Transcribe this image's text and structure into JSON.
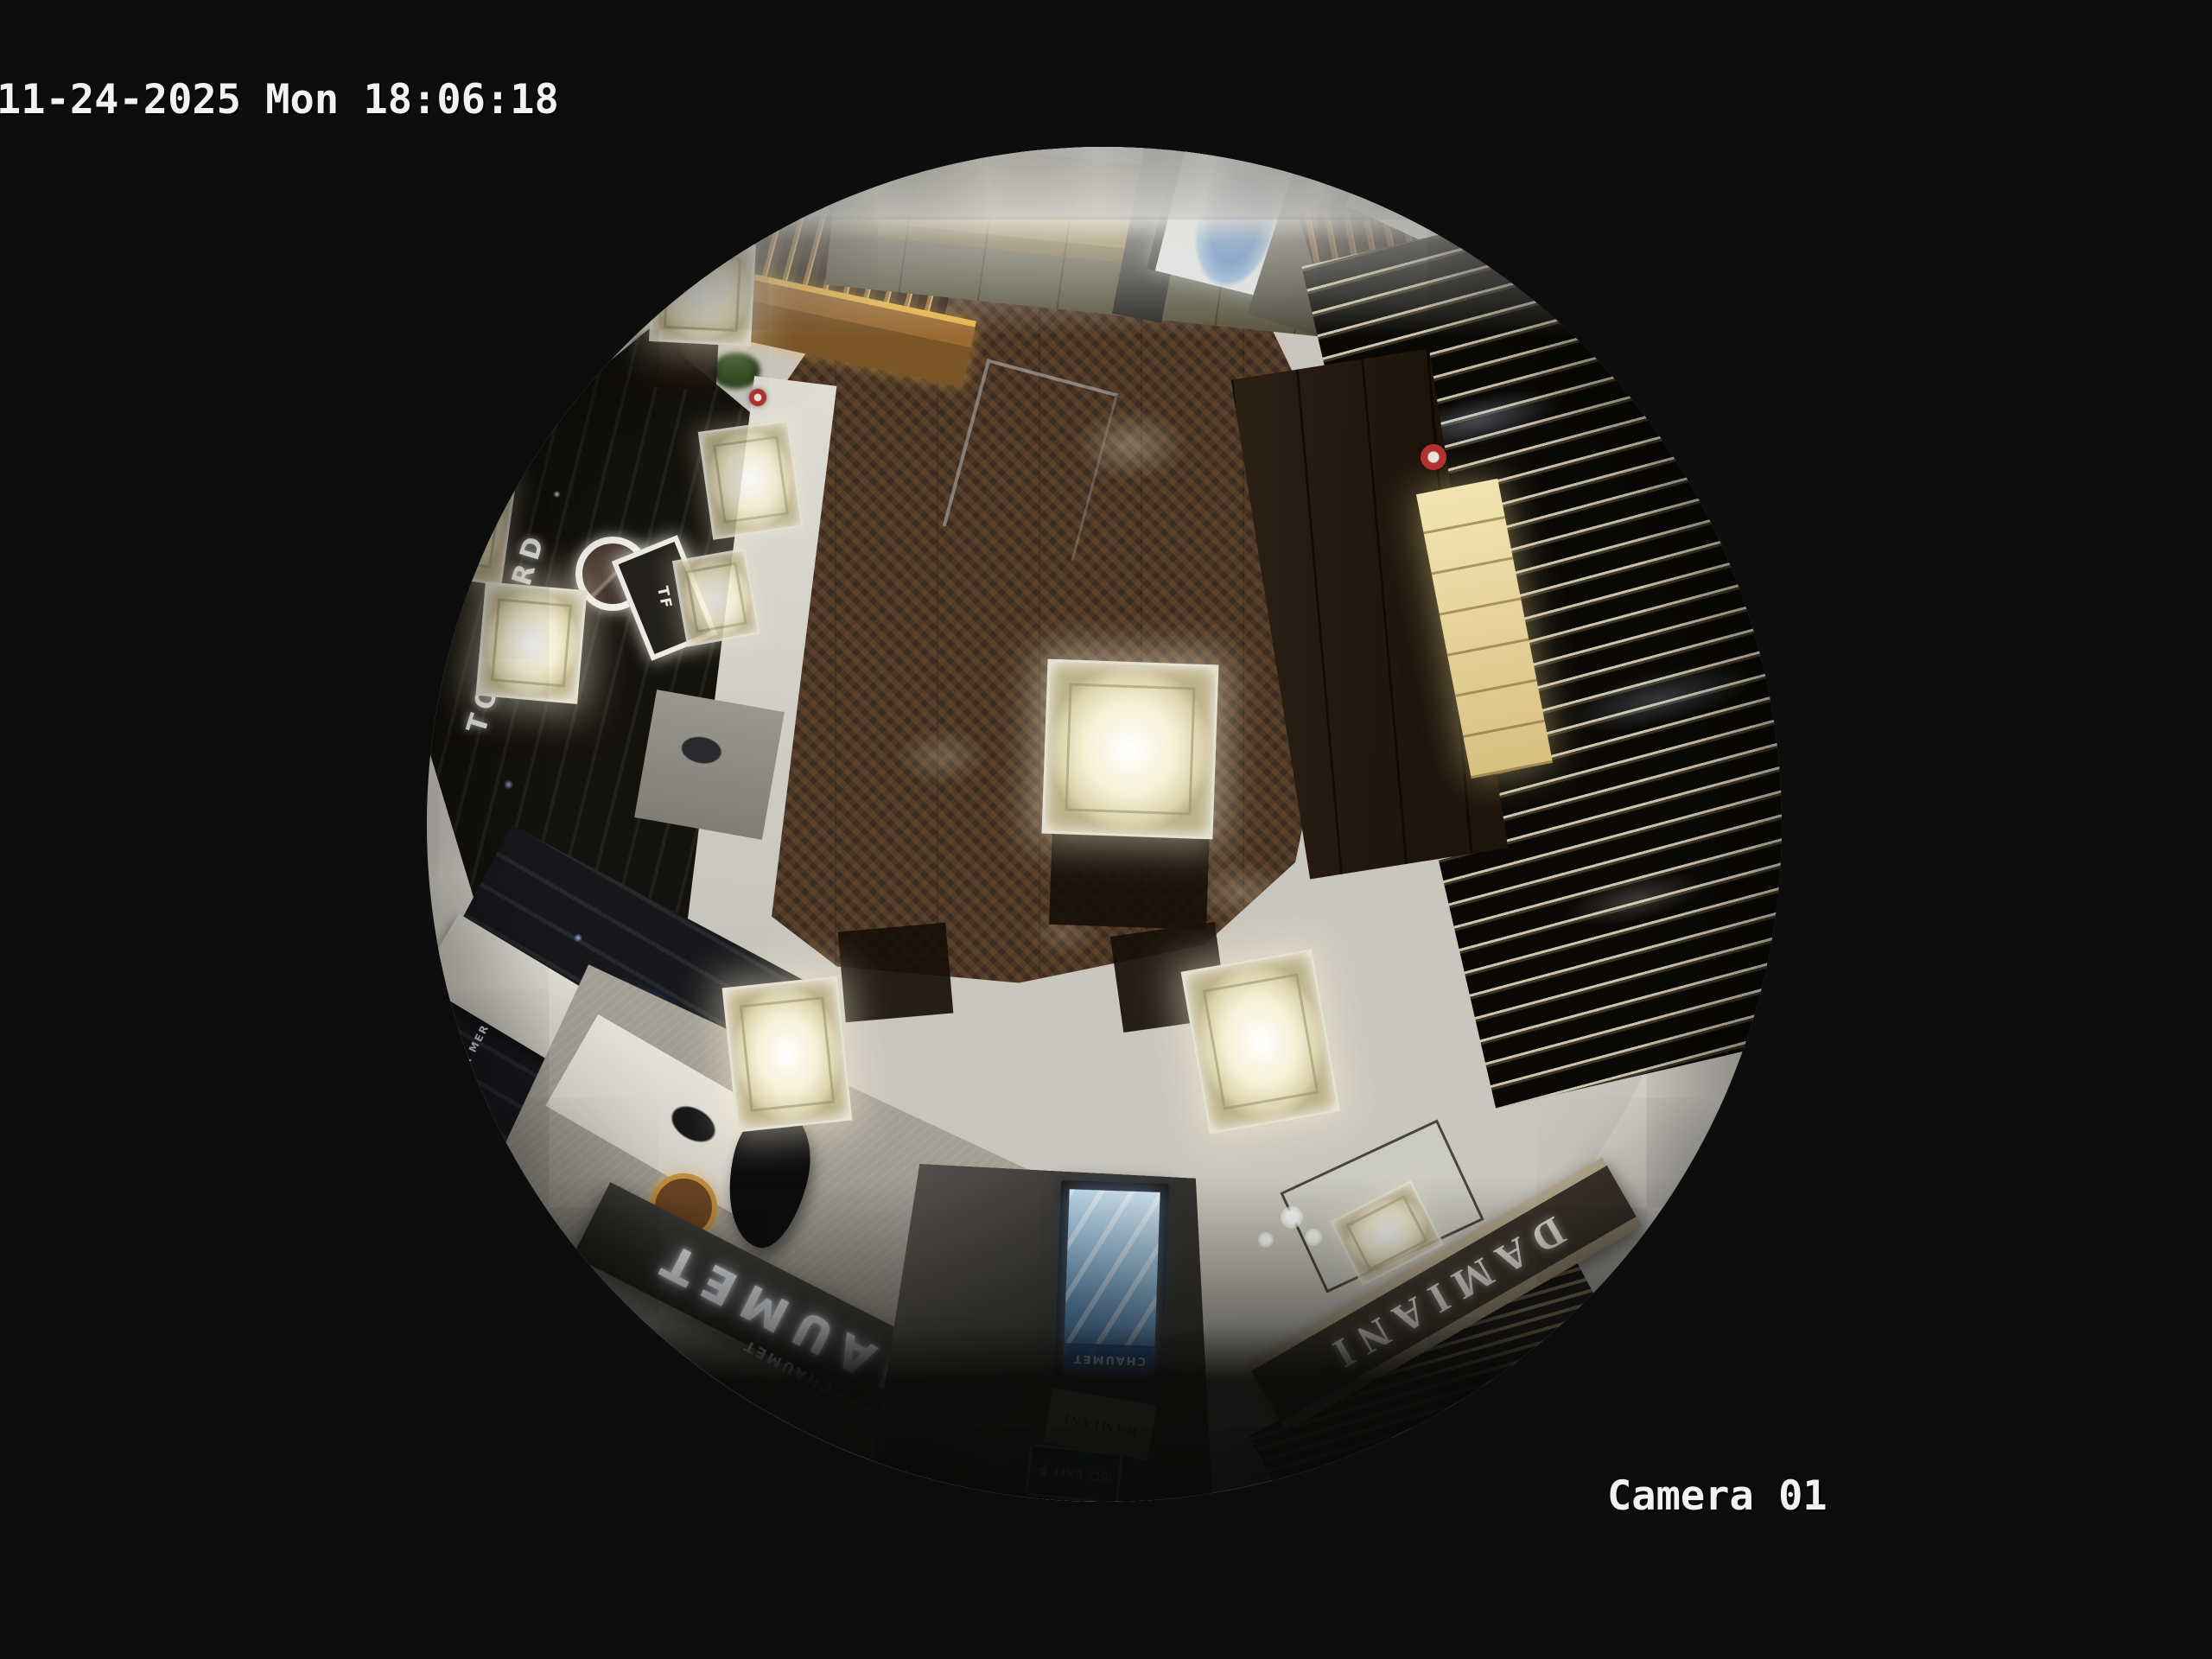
{
  "osd": {
    "timestamp": "11-24-2025 Mon 18:06:18",
    "camera_label": "Camera 01",
    "text_color": "#f2f2f2"
  },
  "scene": {
    "signs": {
      "chaumet_fascia": "CHAUMET",
      "chaumet_boutique_small": "CHAUMET",
      "chaumet_screen": "CHAUMET",
      "damiani_fascia": "DAMIANI",
      "damiani_wall_small": "DAMIANI",
      "tom_ford_fascia": "TOM FORD",
      "tf_monogram": "TF",
      "la_mer_shelf": "LA MER",
      "exit_sign": "出口 EXIT"
    },
    "colors": {
      "background_black": "#0d0d0d",
      "wood_floor": "#3c2c1f",
      "marble_floor": "#c9c6bd",
      "bulkhead_white": "#eceae4",
      "chaumet_fascia_bg": "#2b2a26",
      "damiani_fascia_bg": "#3a332a",
      "exit_green": "#0f5132",
      "kiosk_screen_blue": "#4f87c2",
      "led_amber": "#e8b54a"
    }
  }
}
